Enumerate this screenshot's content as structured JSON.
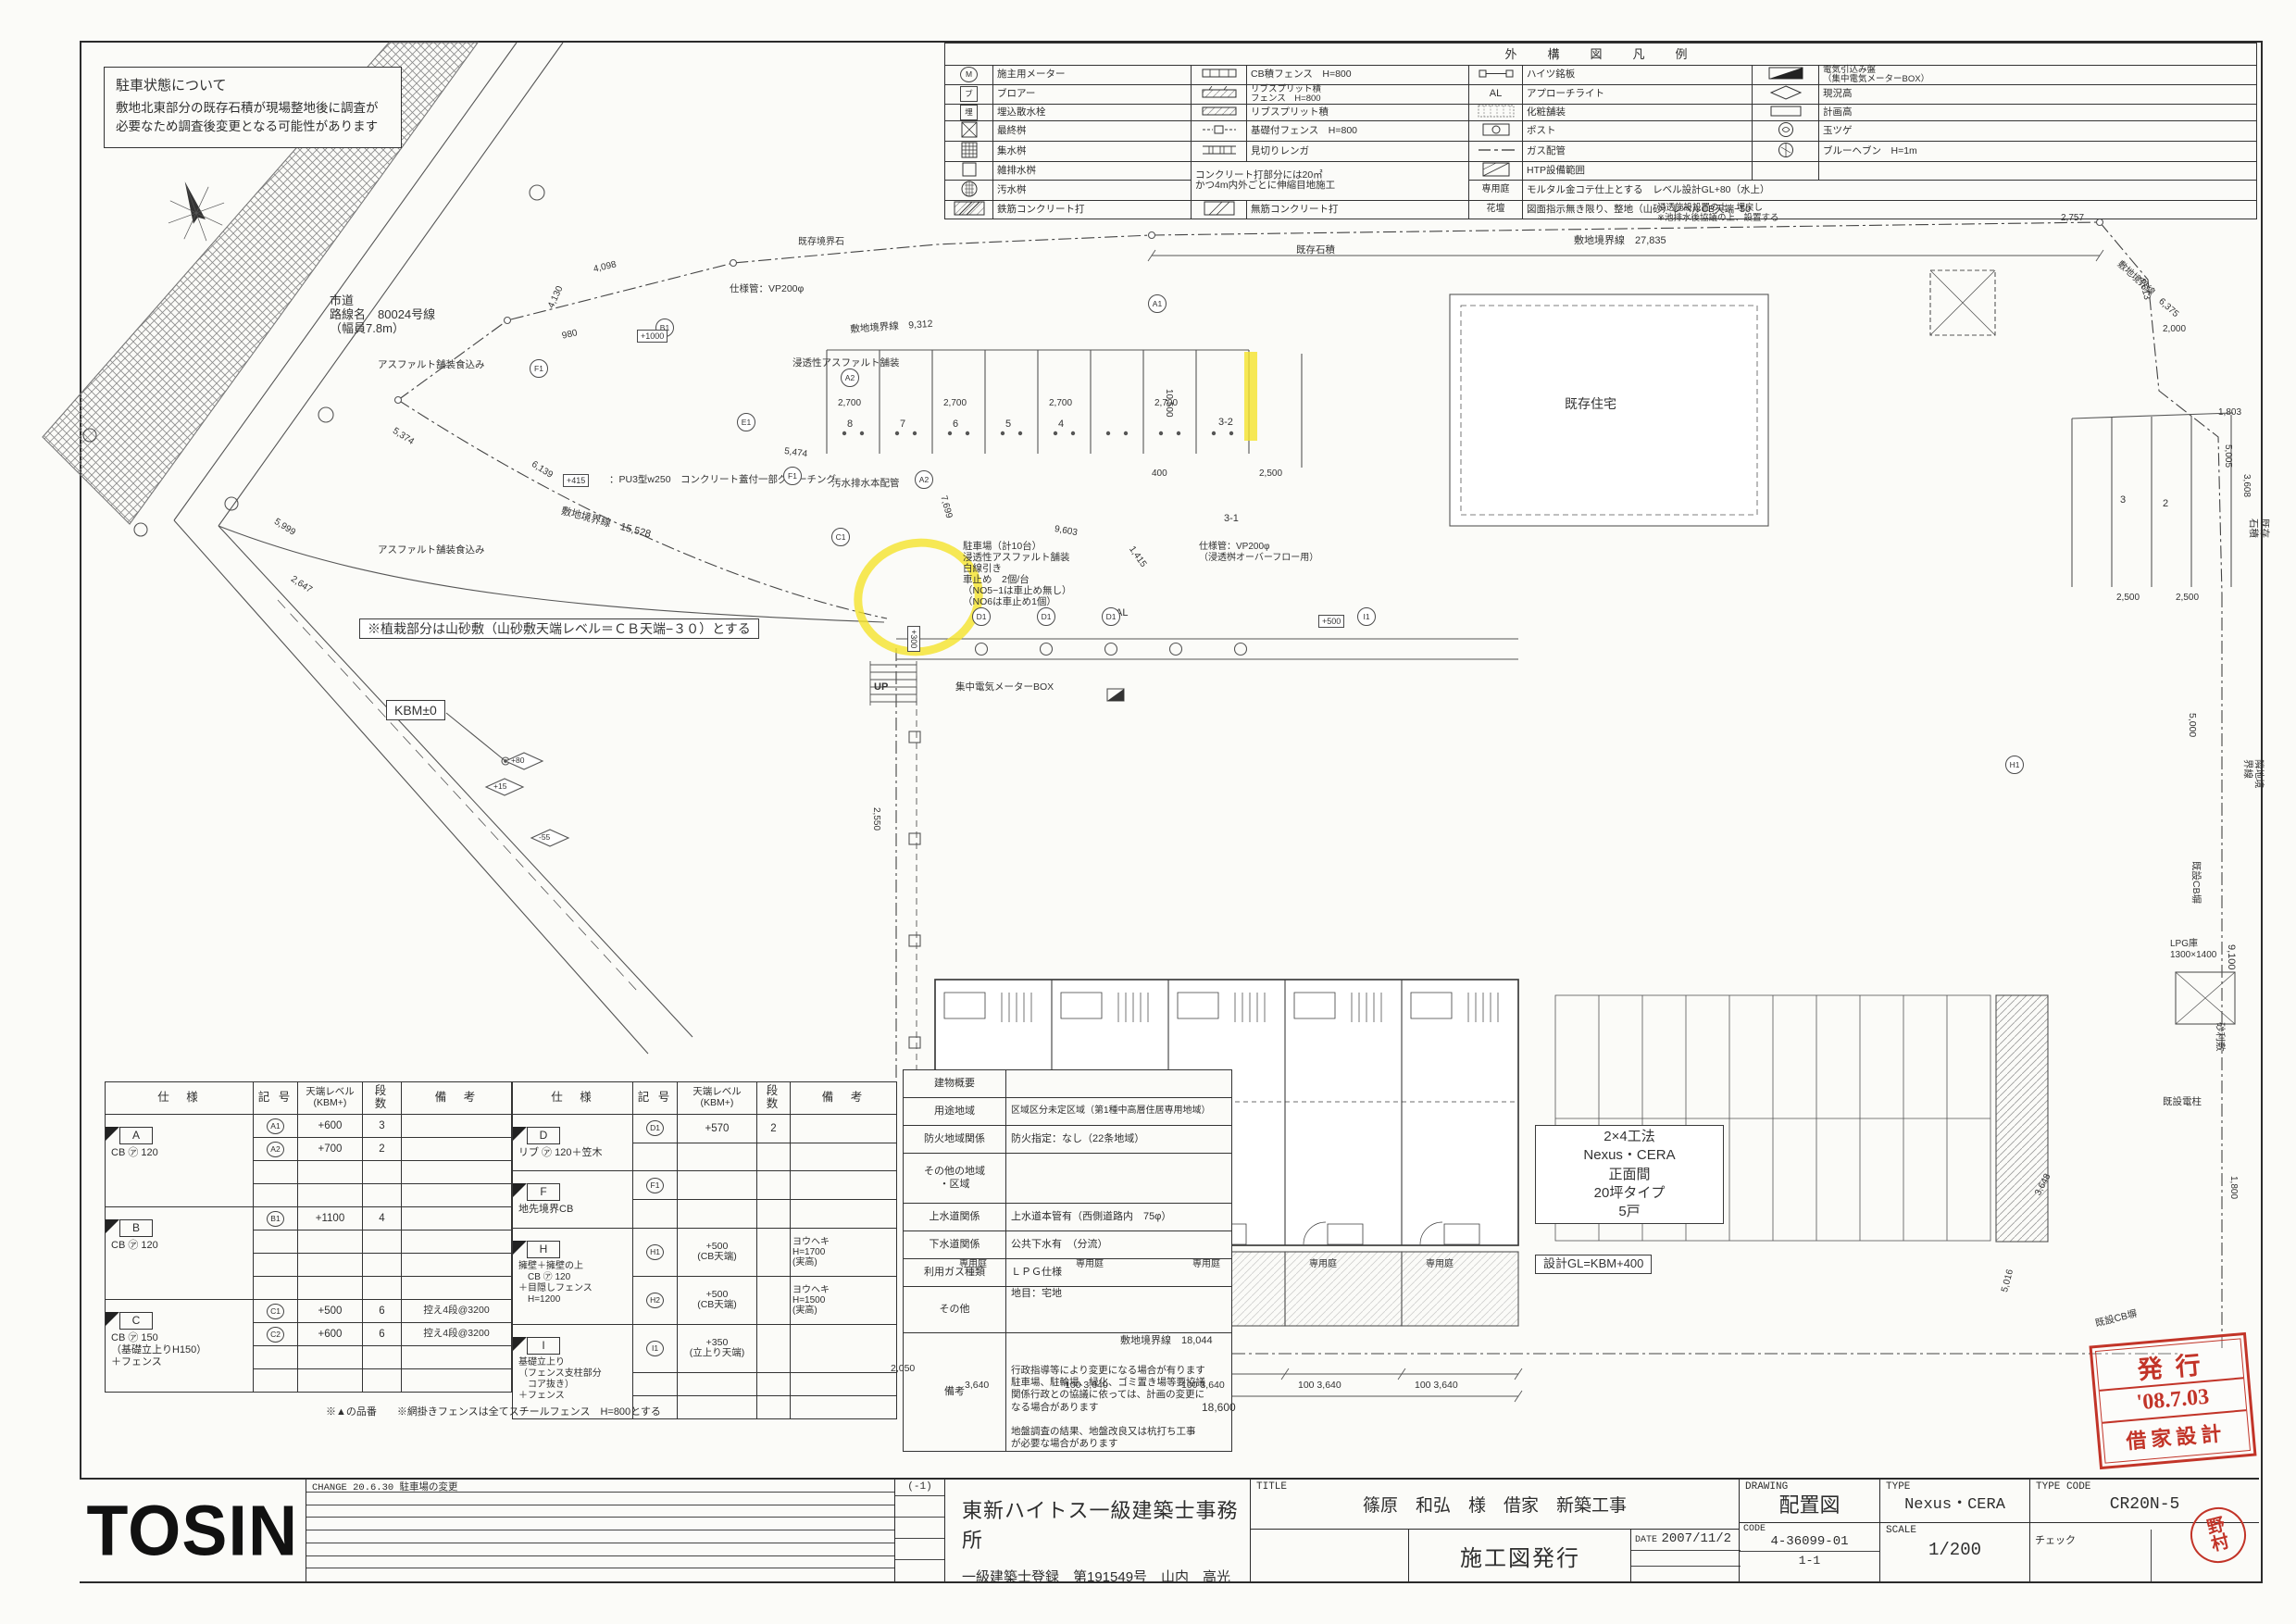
{
  "sheet": {
    "bg": "#fbfbf8",
    "ink": "#2e2e2e",
    "accent_red": "#c23428",
    "highlight_yellow": "#f5e32a"
  },
  "note_box": {
    "title": "駐車状態について",
    "line1": "敷地北東部分の既存石積が現場整地後に調査が",
    "line2": "必要なため調査後変更となる可能性があります"
  },
  "top_notes": {
    "lines": [
      "※構内柱必要　協議の上、位置決定（別途工事）",
      "※既存樹木伐採伐根等（別途工事）",
      "※敷地北湧水池の浸透設備設置に関しては池排水後協議の上、設置する",
      "※敷地内既設排水溝を埋設管に変更、現場にてレベル等再調査の上",
      "　関係者協議の上、設置する",
      "※専用庭はモルタル金コテとする",
      "※既設電柱移設必要（別途工事）",
      "※隣地将来接続用汚水雑排水先行配管止"
    ]
  },
  "legend": {
    "title": "外　構　図　凡　例",
    "sym": {
      "m": "M",
      "bu": "ブ",
      "ume": "埋",
      "al": "AL",
      "teien": "専用庭",
      "kadan": "花壇"
    },
    "r1": {
      "l1": "施主用メーター",
      "l2": "CB積フェンス　H=800",
      "l3": "ハイツ銘板",
      "l4": "電気引込み盤\n（集中電気メーターBOX）"
    },
    "r2": {
      "l1": "ブロアー",
      "l2": "リブスプリット積\nフェンス　H=800",
      "l3": "アプローチライト",
      "l4": "現況高"
    },
    "r3": {
      "l1": "埋込散水栓",
      "l2": "リブスプリット積",
      "l3": "化粧舗装",
      "l4": "計画高"
    },
    "r4": {
      "l1": "最終桝",
      "l2": "基礎付フェンス　H=800",
      "l3": "ポスト",
      "l4": "玉ツゲ"
    },
    "r5": {
      "l1": "集水桝",
      "l2": "見切りレンガ",
      "l3": "ガス配管",
      "l4": "ブルーヘブン　H=1m"
    },
    "r6": {
      "l1": "雑排水桝",
      "note": "コンクリート打部分には20㎡\nかつ4m内外ごとに伸縮目地施工",
      "l3": "HTP設備範囲",
      "l4": ""
    },
    "r7": {
      "l1": "汚水桝",
      "k3": "専用庭",
      "v3": "モルタル金コテ仕上とする　レベル設計GL+80（水上）"
    },
    "r8": {
      "l1": "鉄筋コンクリート打",
      "l2": "無筋コンクリート打",
      "k3": "花壇",
      "v3": "図面指示無き限り、整地（山砂）レベルCB天端−50"
    }
  },
  "spec_headers": [
    "仕　様",
    "記 号",
    "天端レベル\n(KBM+)",
    "段 数",
    "備　考"
  ],
  "spec_table1": {
    "groups": [
      {
        "tag": "A",
        "spec": "CB ㋐ 120",
        "rows": [
          {
            "sym": "A1",
            "level": "+600",
            "dan": "3",
            "biko": ""
          },
          {
            "sym": "A2",
            "level": "+700",
            "dan": "2",
            "biko": ""
          }
        ]
      },
      {
        "tag": "B",
        "spec": "CB ㋐ 120",
        "rows": [
          {
            "sym": "B1",
            "level": "+1100",
            "dan": "4",
            "biko": ""
          }
        ]
      },
      {
        "tag": "C",
        "spec": "CB ㋐ 150\n（基礎立上りH150）\n＋フェンス",
        "rows": [
          {
            "sym": "C1",
            "level": "+500",
            "dan": "6",
            "biko": "控え4段@3200"
          },
          {
            "sym": "C2",
            "level": "+600",
            "dan": "6",
            "biko": "控え4段@3200"
          }
        ]
      }
    ]
  },
  "spec_table2": {
    "groups": [
      {
        "tag": "D",
        "spec": "リブ ㋐ 120＋笠木",
        "rows": [
          {
            "sym": "D1",
            "level": "+570",
            "dan": "2",
            "biko": ""
          }
        ]
      },
      {
        "tag": "F",
        "spec": "地先境界CB",
        "rows": [
          {
            "sym": "F1",
            "level": "",
            "dan": "",
            "biko": ""
          }
        ]
      },
      {
        "tag": "H",
        "spec": "擁壁＋擁壁の上\n　CB ㋐ 120\n＋目隠しフェンス\n　H=1200",
        "rows": [
          {
            "sym": "H1",
            "level": "+500\n(CB天端)",
            "dan": "",
            "biko": "ヨウヘキ\nH=1700\n(実高)"
          },
          {
            "sym": "H2",
            "level": "+500\n(CB天端)",
            "dan": "",
            "biko": "ヨウヘキ\nH=1500\n(実高)"
          }
        ]
      },
      {
        "tag": "I",
        "spec": "基礎立上り\n（フェンス支柱部分\n　コア抜き）\n＋フェンス",
        "rows": [
          {
            "sym": "I1",
            "level": "+350\n(立上り天端)",
            "dan": "",
            "biko": ""
          }
        ]
      }
    ]
  },
  "spec_footnote": "※▲の品番　　※網掛きフェンスは全てスチールフェンス　H=800とする",
  "summary": {
    "rows": [
      {
        "label": "建物概要",
        "value": ""
      },
      {
        "label": "用途地域",
        "value": "区域区分未定区域（第1種中高層住居専用地域）"
      },
      {
        "label": "防火地域関係",
        "value": "防火指定：なし（22条地域）"
      },
      {
        "label": "その他の地域\n・区域",
        "value": ""
      },
      {
        "label": "上水道関係",
        "value": "上水道本管有（西側道路内　75φ）"
      },
      {
        "label": "下水道関係",
        "value": "公共下水有　（分流）"
      },
      {
        "label": "利用ガス種類",
        "value": "ＬＰＧ仕様"
      },
      {
        "label": "その他",
        "value": "地目：宅地"
      },
      {
        "label": "備考",
        "value": "行政指導等により変更になる場合が有ります\n駐車場、駐輪場、緑化、ゴミ置き場等要協議\n関係行政との協議に依っては、計画の変更に\nなる場合があります\n\n地盤調査の結果、地盤改良又は杭打ち工事\nが必要な場合があります"
      }
    ]
  },
  "plan": {
    "kbm": "KBM±0",
    "road": "市道\n路線名　80024号線\n（幅員7.8m）",
    "existing_house": "既存住宅",
    "planting": "※植栽部分は山砂敷（山砂敷天端レベル＝ＣＢ天端−３０）とする",
    "bldg": "2×4工法\nNexus・CERA\n正面間\n20坪タイプ\n5戸",
    "gl": "設計GL=KBM+400",
    "meter": "集中電気メーターBOX",
    "parking": "駐車場（計10台）\n浸透性アスファルト舗装\n白線引き\n車止め　2個/台\n（NO5−1は車止め無し）\n（NO6は車止め1個）",
    "asphalt": "アスファルト舗装食込み",
    "perv_asphalt": "浸透性アスファルト舗装",
    "sewer": "汚水排水本配管",
    "gutter": "：PU3型w250　コンクリート蓋付一部グレーチング",
    "vp": "仕様管：VP200φ",
    "vp2": "仕様管：VP200φ\n（浸透桝オーバーフロー用）",
    "stone": "既存石積",
    "cb": "既設CB塀",
    "boundary_stone": "既存境界石",
    "water_note": "浸透施設設置の上、埋戻し\n※池排水後協議の上、設置する",
    "lpg": "LPG庫\n1300×1400",
    "jari": "砂利敷",
    "pole": "既設電柱",
    "rinchi": "隣地境界線",
    "up": "UP",
    "al": "AL",
    "teien": "専用庭",
    "b27835": "敷地境界線　27,835",
    "b15528": "敷地境界線　15,528",
    "b9312": "敷地境界線　9,312",
    "b18044": "敷地境界線　18,044",
    "b6375": "敷地境界線　6,375",
    "dims": {
      "d2700": "2,700",
      "d2500": "2,500",
      "d400": "400",
      "d3640": "3,640",
      "d100_3640": "100 3,640",
      "d18600": "18,600",
      "d9100": "9,100",
      "d5000": "5,000",
      "d4098": "4,098",
      "d4130": "4,130",
      "d980": "980",
      "d5374": "5,374",
      "d5999": "5,999",
      "d2647": "2,647",
      "d7699": "7,699",
      "d9603": "9,603",
      "d1415": "1,415",
      "d10500": "10,500",
      "d6139": "6,139",
      "d5474": "5,474",
      "d2757": "2,757",
      "d4613": "4,613",
      "d2000": "2,000",
      "d1803": "1,803",
      "d5005": "5,005",
      "d3608": "3,608",
      "d3648": "3,648",
      "d5016": "5,016",
      "d2550": "2,550",
      "d2050": "2,050",
      "d1800": "1,800"
    },
    "markers": {
      "a1": "A1",
      "a2": "A2",
      "b1": "B1",
      "c1": "C1",
      "d1": "D1",
      "e1": "E1",
      "f1": "F1",
      "h1": "H1",
      "i1": "I1"
    },
    "tags": {
      "t80": "+80",
      "t15": "+15",
      "t55": "-55",
      "p500": "+500",
      "p1000": "+1000",
      "p415": "+415",
      "p300": "+300"
    },
    "stalls": {
      "s8": "8",
      "s7": "7",
      "s6": "6",
      "s5": "5",
      "s4": "4",
      "s3": "3",
      "s2": "2",
      "s31": "3-1",
      "s32": "3-2"
    }
  },
  "title_block": {
    "logo": "TOSIN",
    "change_note": "CHANGE 20.6.30 駐車場の変更",
    "rev": "(-1)",
    "office": "東新ハイトス一級建築士事務所",
    "license": "一級建築士登録　第191549号　山内　高光",
    "title_label": "TITLE",
    "title": "篠原　和弘　様　借家　新築工事",
    "issue": "施工図発行",
    "date_label": "DATE",
    "date": "2007/11/2",
    "drawing_label": "DRAWING",
    "drawing": "配置図",
    "code_label": "CODE",
    "code": "4-36099-01",
    "sheet_no": "1-1",
    "type_label": "TYPE",
    "type": "Nexus・CERA",
    "scale_label": "SCALE",
    "scale": "1/200",
    "typecode_label": "TYPE CODE",
    "typecode": "CR20N-5",
    "check_label": "チェック"
  },
  "stamps": {
    "issue_line1": "発行",
    "issue_line2": "'08.7.03",
    "issue_line3": "借家設計",
    "checker": "野\n村"
  },
  "icons": {
    "legend_icons": [
      "meter-circle-icon",
      "blower-box-icon",
      "sprinkler-box-icon",
      "final-pit-x-icon",
      "catch-basin-grid-icon",
      "waste-pit-box-icon",
      "sewage-pit-circle-icon",
      "rc-concrete-hatch-icon",
      "cb-fence-icon",
      "ribsplit-fence-icon",
      "ribsplit-hatch-icon",
      "foundation-fence-icon",
      "edge-brick-icon",
      "plain-concrete-hatch-icon",
      "nameplate-icon",
      "approach-light-icon",
      "paving-brick-icon",
      "post-icon",
      "gas-pipe-icon",
      "htp-range-icon",
      "electric-panel-icon",
      "existing-level-diamond-icon",
      "plan-level-rect-icon",
      "boxtree-icon",
      "blueheaven-icon"
    ],
    "plan_icons": [
      "north-compass-icon",
      "road-crosshatch-icon",
      "percolation-pit-icon",
      "manhole-icon",
      "stair-icon"
    ]
  }
}
